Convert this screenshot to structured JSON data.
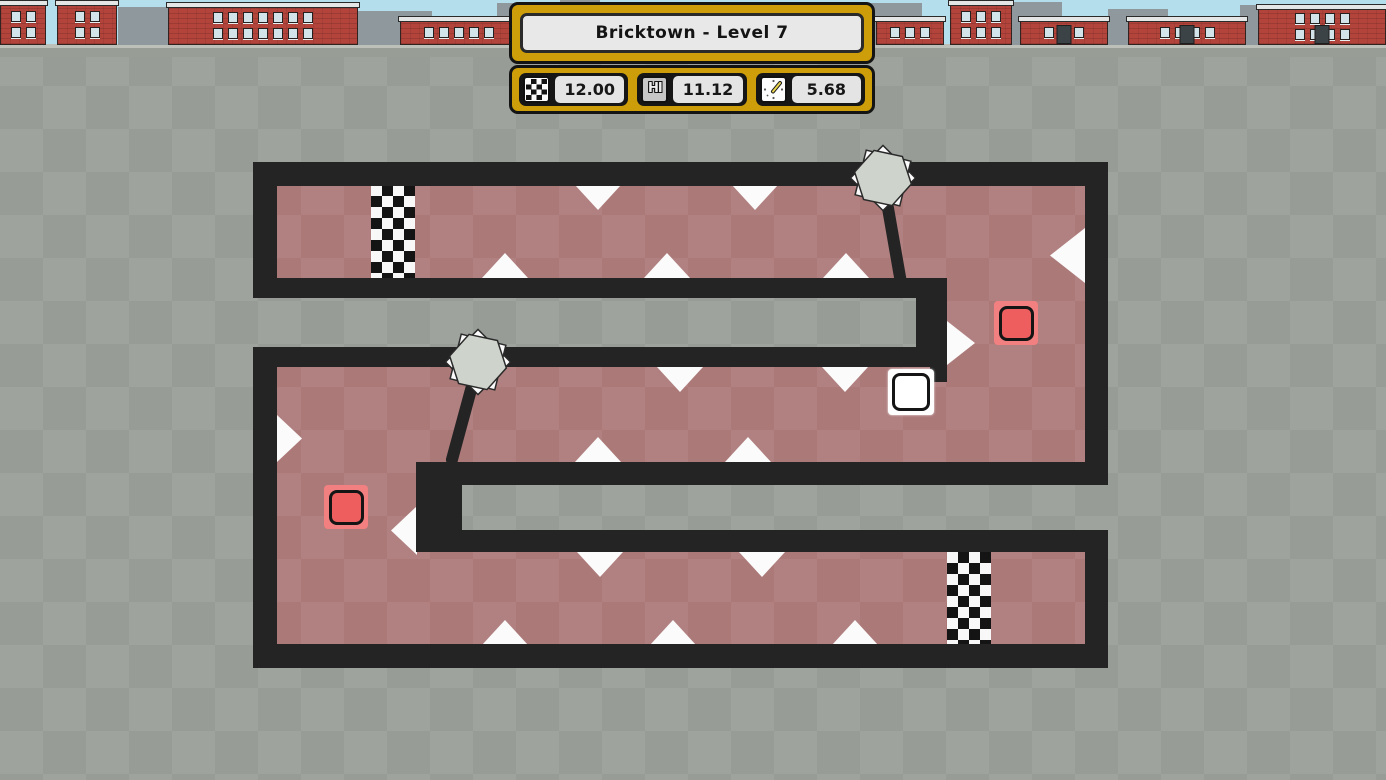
{
  "hud": {
    "title": "Bricktown - Level 7",
    "stats": [
      {
        "icon": "finish-flag",
        "value": "12.00"
      },
      {
        "icon": "high-score",
        "icon_label": "HI",
        "value": "11.12"
      },
      {
        "icon": "timer",
        "value": "5.68"
      }
    ]
  },
  "colors": {
    "wall": "#242424",
    "floor": "#ac7979",
    "floor_alt": "#b38181",
    "background": "#979c96",
    "sky": "#b5deec",
    "brick": "#b2443c",
    "hazard": "#ee5e5e",
    "hazard_glow": "#f28080",
    "player": "#ffffff",
    "saw_blade": "#ced3cc",
    "spike": "#fbfbfb",
    "hud_gold": "#cd9e0a",
    "finish_dark": "#141414",
    "finish_light": "#f8f8f8"
  },
  "skyline": {
    "buildings": [
      {
        "type": "gray",
        "x": 118,
        "w": 58,
        "h": 38
      },
      {
        "type": "gray",
        "x": 358,
        "w": 74,
        "h": 34
      },
      {
        "type": "gray",
        "x": 497,
        "w": 70,
        "h": 42
      },
      {
        "type": "gray",
        "x": 560,
        "w": 40,
        "h": 45
      },
      {
        "type": "gray",
        "x": 648,
        "w": 90,
        "h": 36
      },
      {
        "type": "gray",
        "x": 852,
        "w": 70,
        "h": 42
      },
      {
        "type": "gray",
        "x": 1012,
        "w": 50,
        "h": 43
      },
      {
        "type": "gray",
        "x": 1108,
        "w": 60,
        "h": 36
      },
      {
        "type": "gray",
        "x": 1240,
        "w": 50,
        "h": 40
      },
      {
        "type": "brick",
        "x": 0,
        "w": 46,
        "h": 42,
        "win": {
          "rows": 2,
          "cols": 2
        }
      },
      {
        "type": "brick",
        "x": 57,
        "w": 60,
        "h": 42,
        "win": {
          "rows": 2,
          "cols": 2
        }
      },
      {
        "type": "brick",
        "x": 168,
        "w": 190,
        "h": 40,
        "win": {
          "rows": 2,
          "cols": 7
        }
      },
      {
        "type": "brick",
        "x": 400,
        "w": 118,
        "h": 26,
        "win": {
          "rows": 1,
          "cols": 5
        }
      },
      {
        "type": "brick",
        "x": 700,
        "w": 70,
        "h": 26,
        "win": {
          "rows": 1,
          "cols": 3
        }
      },
      {
        "type": "brick",
        "x": 876,
        "w": 68,
        "h": 26,
        "win": {
          "rows": 1,
          "cols": 3
        }
      },
      {
        "type": "brick",
        "x": 950,
        "w": 62,
        "h": 42,
        "win": {
          "rows": 2,
          "cols": 3
        }
      },
      {
        "type": "brick",
        "x": 1020,
        "w": 88,
        "h": 26,
        "win": {
          "rows": 1,
          "cols": 3
        },
        "door": true
      },
      {
        "type": "brick",
        "x": 1128,
        "w": 118,
        "h": 26,
        "win": {
          "rows": 1,
          "cols": 4
        },
        "door": true
      },
      {
        "type": "brick",
        "x": 1258,
        "w": 128,
        "h": 38,
        "win": {
          "rows": 2,
          "cols": 4
        },
        "door": true
      }
    ]
  },
  "maze": {
    "floors": [
      {
        "x": 276,
        "y": 185,
        "w": 809,
        "h": 93
      },
      {
        "x": 947,
        "y": 278,
        "w": 138,
        "h": 89
      },
      {
        "x": 277,
        "y": 367,
        "w": 808,
        "h": 95
      },
      {
        "x": 277,
        "y": 462,
        "w": 139,
        "h": 90
      },
      {
        "x": 277,
        "y": 552,
        "w": 808,
        "h": 92
      }
    ],
    "walls": [
      {
        "x": 253,
        "y": 162,
        "w": 855,
        "h": 24
      },
      {
        "x": 253,
        "y": 162,
        "w": 24,
        "h": 136
      },
      {
        "x": 1085,
        "y": 162,
        "w": 23,
        "h": 323
      },
      {
        "x": 253,
        "y": 278,
        "w": 694,
        "h": 20
      },
      {
        "x": 253,
        "y": 347,
        "w": 694,
        "h": 20
      },
      {
        "x": 916,
        "y": 278,
        "w": 31,
        "h": 89
      },
      {
        "x": 930,
        "y": 360,
        "w": 17,
        "h": 22
      },
      {
        "x": 253,
        "y": 347,
        "w": 24,
        "h": 321
      },
      {
        "x": 416,
        "y": 462,
        "w": 692,
        "h": 23
      },
      {
        "x": 416,
        "y": 530,
        "w": 692,
        "h": 22
      },
      {
        "x": 416,
        "y": 462,
        "w": 46,
        "h": 90
      },
      {
        "x": 1085,
        "y": 530,
        "w": 23,
        "h": 138
      },
      {
        "x": 253,
        "y": 644,
        "w": 855,
        "h": 24
      }
    ],
    "finish_zones": [
      {
        "x": 371,
        "y": 185,
        "w": 44,
        "h": 93
      },
      {
        "x": 947,
        "y": 552,
        "w": 44,
        "h": 92
      }
    ],
    "spikes": [
      {
        "x": 575,
        "y": 185,
        "w": 46,
        "h": 25,
        "dir": "down"
      },
      {
        "x": 732,
        "y": 185,
        "w": 46,
        "h": 25,
        "dir": "down"
      },
      {
        "x": 482,
        "y": 253,
        "w": 46,
        "h": 25,
        "dir": "up"
      },
      {
        "x": 644,
        "y": 253,
        "w": 46,
        "h": 25,
        "dir": "up"
      },
      {
        "x": 823,
        "y": 253,
        "w": 46,
        "h": 25,
        "dir": "up"
      },
      {
        "x": 1050,
        "y": 228,
        "w": 35,
        "h": 55,
        "dir": "left"
      },
      {
        "x": 947,
        "y": 321,
        "w": 28,
        "h": 44,
        "dir": "right"
      },
      {
        "x": 657,
        "y": 367,
        "w": 46,
        "h": 25,
        "dir": "down"
      },
      {
        "x": 822,
        "y": 367,
        "w": 46,
        "h": 25,
        "dir": "down"
      },
      {
        "x": 277,
        "y": 415,
        "w": 25,
        "h": 47,
        "dir": "right"
      },
      {
        "x": 575,
        "y": 437,
        "w": 46,
        "h": 25,
        "dir": "up"
      },
      {
        "x": 725,
        "y": 437,
        "w": 46,
        "h": 25,
        "dir": "up"
      },
      {
        "x": 391,
        "y": 506,
        "w": 26,
        "h": 49,
        "dir": "left"
      },
      {
        "x": 577,
        "y": 552,
        "w": 46,
        "h": 25,
        "dir": "down"
      },
      {
        "x": 739,
        "y": 552,
        "w": 46,
        "h": 25,
        "dir": "down"
      },
      {
        "x": 482,
        "y": 620,
        "w": 46,
        "h": 25,
        "dir": "up"
      },
      {
        "x": 650,
        "y": 620,
        "w": 46,
        "h": 25,
        "dir": "up"
      },
      {
        "x": 832,
        "y": 620,
        "w": 46,
        "h": 25,
        "dir": "up"
      }
    ],
    "saws": [
      {
        "cx": 883,
        "cy": 178,
        "pivot_x": 902,
        "pivot_y": 287
      },
      {
        "cx": 478,
        "cy": 362,
        "pivot_x": 450,
        "pivot_y": 465
      }
    ],
    "hazard_squares": [
      {
        "cx": 1016,
        "cy": 323
      },
      {
        "cx": 346,
        "cy": 507
      }
    ],
    "player": {
      "cx": 911,
      "cy": 392
    }
  }
}
